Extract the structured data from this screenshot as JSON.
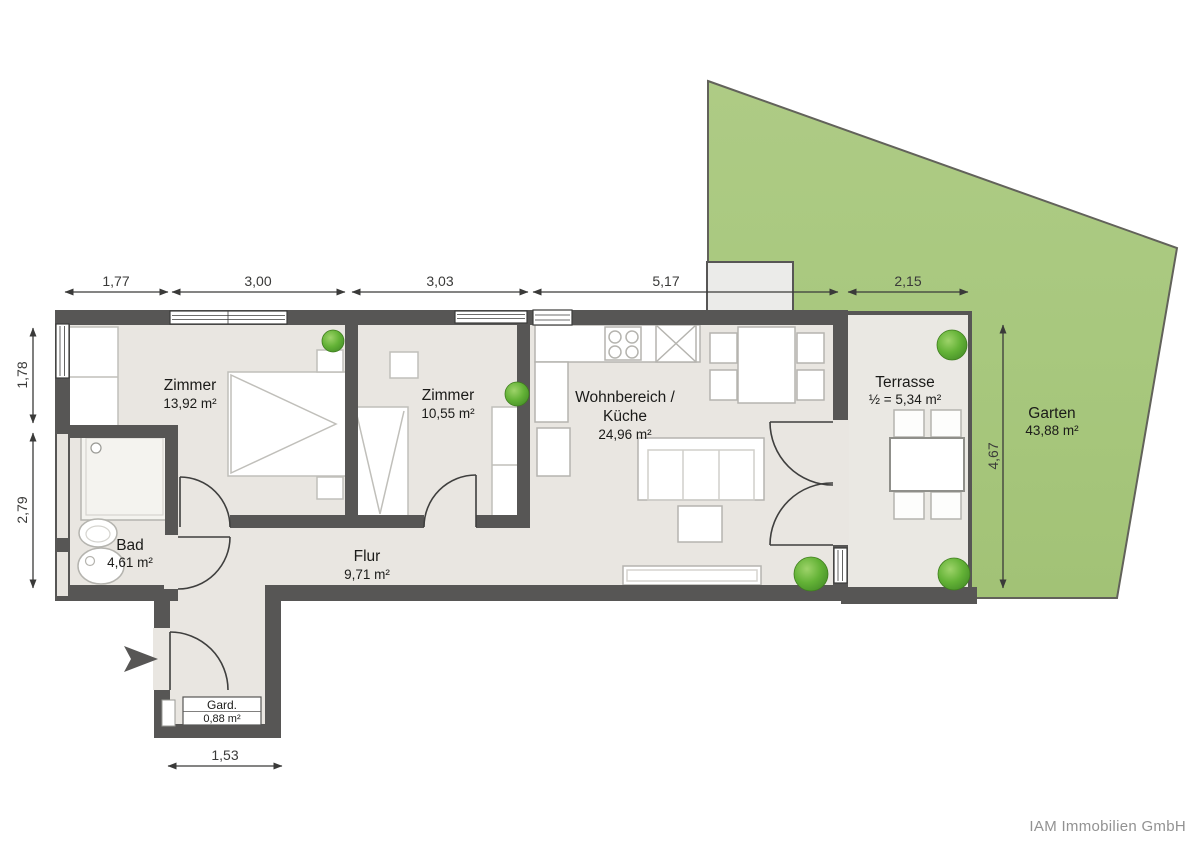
{
  "floorplan": {
    "rooms": [
      {
        "id": "zimmer-1",
        "name": "Zimmer",
        "area": "13,92 m²"
      },
      {
        "id": "zimmer-2",
        "name": "Zimmer",
        "area": "10,55 m²"
      },
      {
        "id": "wohnbereich-kueche",
        "name": "Wohnbereich /",
        "name2": "Küche",
        "area": "24,96 m²"
      },
      {
        "id": "terrasse",
        "name": "Terrasse",
        "area": "½ = 5,34 m²"
      },
      {
        "id": "garten",
        "name": "Garten",
        "area": "43,88 m²"
      },
      {
        "id": "bad",
        "name": "Bad",
        "area": "4,61 m²"
      },
      {
        "id": "flur",
        "name": "Flur",
        "area": "9,71 m²"
      },
      {
        "id": "garderobe",
        "name": "Gard.",
        "area": "0,88 m²"
      }
    ],
    "dimensions": {
      "top": [
        "1,77",
        "3,00",
        "3,03",
        "5,17",
        "2,15"
      ],
      "left": [
        "1,78",
        "2,79"
      ],
      "right": [
        "4,67"
      ],
      "bottom": [
        "1,53"
      ]
    },
    "icons": {
      "plant": "bush-icon",
      "entrance": "entrance-arrow-icon"
    },
    "colors": {
      "wall": "#575655",
      "floor": "#e9e6e1",
      "garden": "#a8c87e",
      "bush": "#5fa33a",
      "dimension": "#3a3a39"
    },
    "footer": "IAM Immobilien GmbH"
  }
}
